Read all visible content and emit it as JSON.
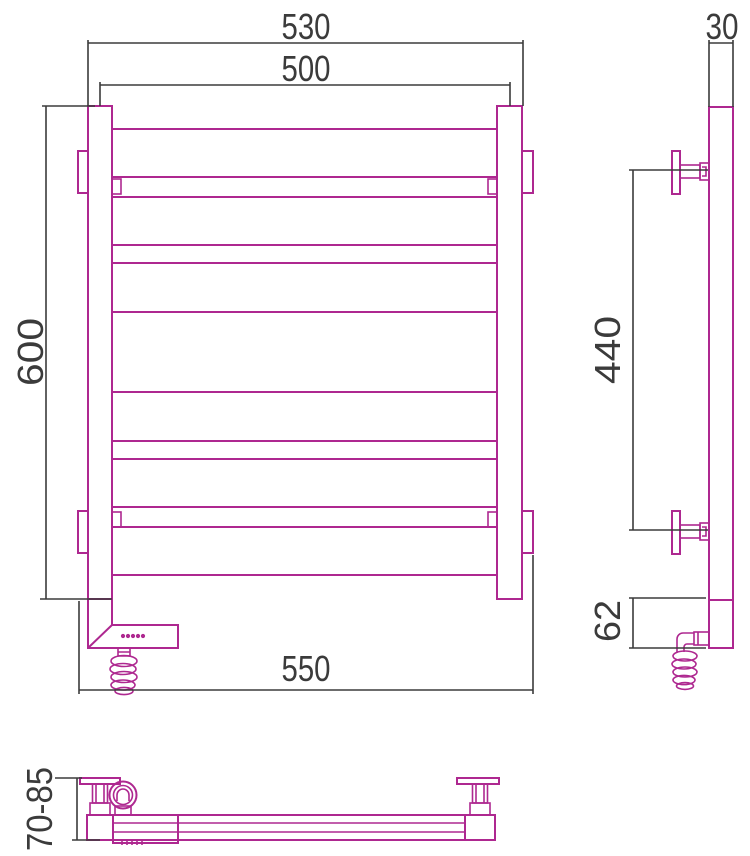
{
  "drawing": {
    "type": "technical-drawing",
    "subject": "ladder heated towel rail with electric heating unit and coiled power cord",
    "views": [
      "front",
      "side",
      "bottom"
    ]
  },
  "dimensions": {
    "outer_width": {
      "value": "530",
      "applies_to": "front view, outer edge of vertical posts"
    },
    "center_width": {
      "value": "500",
      "applies_to": "front view, post centre to post centre"
    },
    "height": {
      "value": "600",
      "applies_to": "front view, overall post height"
    },
    "overall_width": {
      "value": "550",
      "applies_to": "front view, wall bracket to wall bracket"
    },
    "depth": {
      "value": "30",
      "applies_to": "side view, post depth"
    },
    "bracket_spacing": {
      "value": "440",
      "applies_to": "side view, distance between wall brackets"
    },
    "heater_section": {
      "value": "62",
      "applies_to": "side view, electric heater housing height"
    },
    "wall_clearance": {
      "value": "70-85",
      "applies_to": "bottom view, wall to front face distance"
    }
  },
  "colors": {
    "outline": "#ae2890",
    "dimension": "#3b3b3b",
    "background": "#ffffff"
  }
}
